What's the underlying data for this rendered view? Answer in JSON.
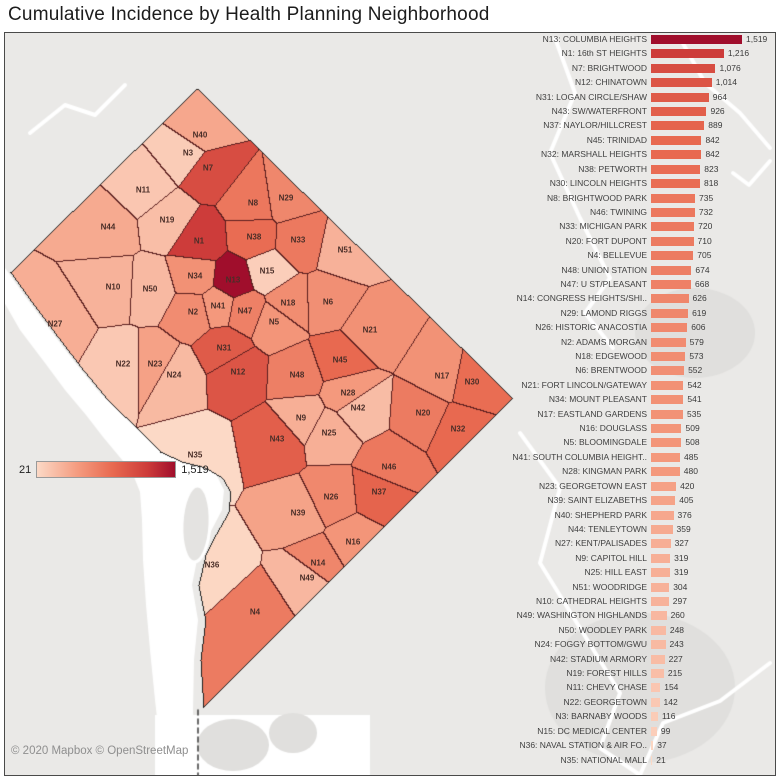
{
  "title": "Cumulative Incidence by Health Planning Neighborhood",
  "map": {
    "attribution": "© 2020 Mapbox © OpenStreetMap",
    "legend": {
      "min": "21",
      "max": "1,519"
    }
  },
  "colors": {
    "map_bg": "#eae9e7",
    "map_patch": "#e0dfdd",
    "water": "#ffffff",
    "region_border": "#5a1e1e",
    "outline": "#1f1f1f",
    "map_label": "#4a2e28",
    "bar_text": "#3f3f3f",
    "attribution_text": "#8f8f8f",
    "ramp": [
      [
        "0",
        "#fcd9c6"
      ],
      [
        "0.3",
        "#f49a7e"
      ],
      [
        "0.55",
        "#e86950"
      ],
      [
        "0.8",
        "#cd3c3a"
      ],
      [
        "1",
        "#a00e2c"
      ]
    ]
  },
  "chart_data": {
    "type": "bar",
    "orientation": "horizontal",
    "title": "Cumulative Incidence by Health Planning Neighborhood",
    "xlabel": "",
    "ylabel": "",
    "sort": "descending",
    "xlim": [
      0,
      1519
    ],
    "value_min": 21,
    "value_max": 1519,
    "grid": false,
    "legend_position": "map-overlay-left",
    "categories": [
      "N13: COLUMBIA HEIGHTS",
      "N1: 16th ST HEIGHTS",
      "N7: BRIGHTWOOD",
      "N12: CHINATOWN",
      "N31: LOGAN CIRCLE/SHAW",
      "N43: SW/WATERFRONT",
      "N37: NAYLOR/HILLCREST",
      "N45: TRINIDAD",
      "N32: MARSHALL HEIGHTS",
      "N38: PETWORTH",
      "N30: LINCOLN HEIGHTS",
      "N8: BRIGHTWOOD PARK",
      "N46: TWINING",
      "N33: MICHIGAN PARK",
      "N20: FORT DUPONT",
      "N4: BELLEVUE",
      "N48: UNION STATION",
      "N47: U ST/PLEASANT",
      "N14: CONGRESS HEIGHTS/SHI..",
      "N29: LAMOND RIGGS",
      "N26: HISTORIC ANACOSTIA",
      "N2: ADAMS MORGAN",
      "N18: EDGEWOOD",
      "N6: BRENTWOOD",
      "N21: FORT LINCOLN/GATEWAY",
      "N34: MOUNT PLEASANT",
      "N17: EASTLAND GARDENS",
      "N16: DOUGLASS",
      "N5: BLOOMINGDALE",
      "N41: SOUTH COLUMBIA HEIGHT..",
      "N28: KINGMAN PARK",
      "N23: GEORGETOWN EAST",
      "N39: SAINT ELIZABETHS",
      "N40: SHEPHERD PARK",
      "N44: TENLEYTOWN",
      "N27: KENT/PALISADES",
      "N9: CAPITOL HILL",
      "N25: HILL EAST",
      "N51: WOODRIDGE",
      "N10: CATHEDRAL HEIGHTS",
      "N49: WASHINGTON HIGHLANDS",
      "N50: WOODLEY PARK",
      "N24: FOGGY BOTTOM/GWU",
      "N42: STADIUM ARMORY",
      "N19: FOREST HILLS",
      "N11: CHEVY CHASE",
      "N22: GEORGETOWN",
      "N3: BARNABY WOODS",
      "N15: DC MEDICAL CENTER",
      "N36: NAVAL STATION & AIR FO..",
      "N35: NATIONAL MALL"
    ],
    "values": [
      1519,
      1216,
      1076,
      1014,
      964,
      926,
      889,
      842,
      842,
      823,
      818,
      735,
      732,
      720,
      710,
      705,
      674,
      668,
      626,
      619,
      606,
      579,
      573,
      552,
      542,
      541,
      535,
      509,
      508,
      485,
      480,
      420,
      405,
      376,
      359,
      327,
      319,
      319,
      304,
      297,
      260,
      248,
      243,
      227,
      215,
      154,
      142,
      116,
      99,
      37,
      21
    ],
    "value_labels": [
      "1,519",
      "1,216",
      "1,076",
      "1,014",
      "964",
      "926",
      "889",
      "842",
      "842",
      "823",
      "818",
      "735",
      "732",
      "720",
      "710",
      "705",
      "674",
      "668",
      "626",
      "619",
      "606",
      "579",
      "573",
      "552",
      "542",
      "541",
      "535",
      "509",
      "508",
      "485",
      "480",
      "420",
      "405",
      "376",
      "359",
      "327",
      "319",
      "319",
      "304",
      "297",
      "260",
      "248",
      "243",
      "227",
      "215",
      "154",
      "142",
      "116",
      "99",
      "37",
      "21"
    ],
    "map_points": [
      {
        "id": "N13",
        "x": 233,
        "y": 280
      },
      {
        "id": "N1",
        "x": 199,
        "y": 241
      },
      {
        "id": "N7",
        "x": 208,
        "y": 168
      },
      {
        "id": "N12",
        "x": 238,
        "y": 372
      },
      {
        "id": "N31",
        "x": 224,
        "y": 348
      },
      {
        "id": "N43",
        "x": 277,
        "y": 439
      },
      {
        "id": "N37",
        "x": 379,
        "y": 492
      },
      {
        "id": "N45",
        "x": 340,
        "y": 360
      },
      {
        "id": "N32",
        "x": 458,
        "y": 429
      },
      {
        "id": "N38",
        "x": 254,
        "y": 237
      },
      {
        "id": "N30",
        "x": 472,
        "y": 382
      },
      {
        "id": "N8",
        "x": 253,
        "y": 203
      },
      {
        "id": "N46",
        "x": 389,
        "y": 467
      },
      {
        "id": "N33",
        "x": 298,
        "y": 240
      },
      {
        "id": "N20",
        "x": 423,
        "y": 413
      },
      {
        "id": "N4",
        "x": 255,
        "y": 612
      },
      {
        "id": "N48",
        "x": 297,
        "y": 375
      },
      {
        "id": "N47",
        "x": 245,
        "y": 311
      },
      {
        "id": "N14",
        "x": 318,
        "y": 563
      },
      {
        "id": "N29",
        "x": 286,
        "y": 198
      },
      {
        "id": "N26",
        "x": 331,
        "y": 497
      },
      {
        "id": "N2",
        "x": 193,
        "y": 312
      },
      {
        "id": "N18",
        "x": 288,
        "y": 303
      },
      {
        "id": "N6",
        "x": 328,
        "y": 302
      },
      {
        "id": "N21",
        "x": 370,
        "y": 330
      },
      {
        "id": "N34",
        "x": 195,
        "y": 276
      },
      {
        "id": "N17",
        "x": 442,
        "y": 376
      },
      {
        "id": "N16",
        "x": 353,
        "y": 542
      },
      {
        "id": "N5",
        "x": 274,
        "y": 322
      },
      {
        "id": "N41",
        "x": 218,
        "y": 306
      },
      {
        "id": "N28",
        "x": 348,
        "y": 393
      },
      {
        "id": "N23",
        "x": 155,
        "y": 364
      },
      {
        "id": "N39",
        "x": 298,
        "y": 513
      },
      {
        "id": "N40",
        "x": 200,
        "y": 135
      },
      {
        "id": "N44",
        "x": 108,
        "y": 227
      },
      {
        "id": "N27",
        "x": 55,
        "y": 324
      },
      {
        "id": "N9",
        "x": 301,
        "y": 418
      },
      {
        "id": "N25",
        "x": 329,
        "y": 433
      },
      {
        "id": "N51",
        "x": 345,
        "y": 250
      },
      {
        "id": "N10",
        "x": 113,
        "y": 287
      },
      {
        "id": "N49",
        "x": 307,
        "y": 578
      },
      {
        "id": "N50",
        "x": 150,
        "y": 289
      },
      {
        "id": "N24",
        "x": 174,
        "y": 375
      },
      {
        "id": "N42",
        "x": 358,
        "y": 408
      },
      {
        "id": "N19",
        "x": 167,
        "y": 220
      },
      {
        "id": "N11",
        "x": 143,
        "y": 190
      },
      {
        "id": "N22",
        "x": 123,
        "y": 364
      },
      {
        "id": "N3",
        "x": 188,
        "y": 153
      },
      {
        "id": "N15",
        "x": 267,
        "y": 271
      },
      {
        "id": "N36",
        "x": 212,
        "y": 565
      },
      {
        "id": "N35",
        "x": 195,
        "y": 455
      }
    ]
  }
}
